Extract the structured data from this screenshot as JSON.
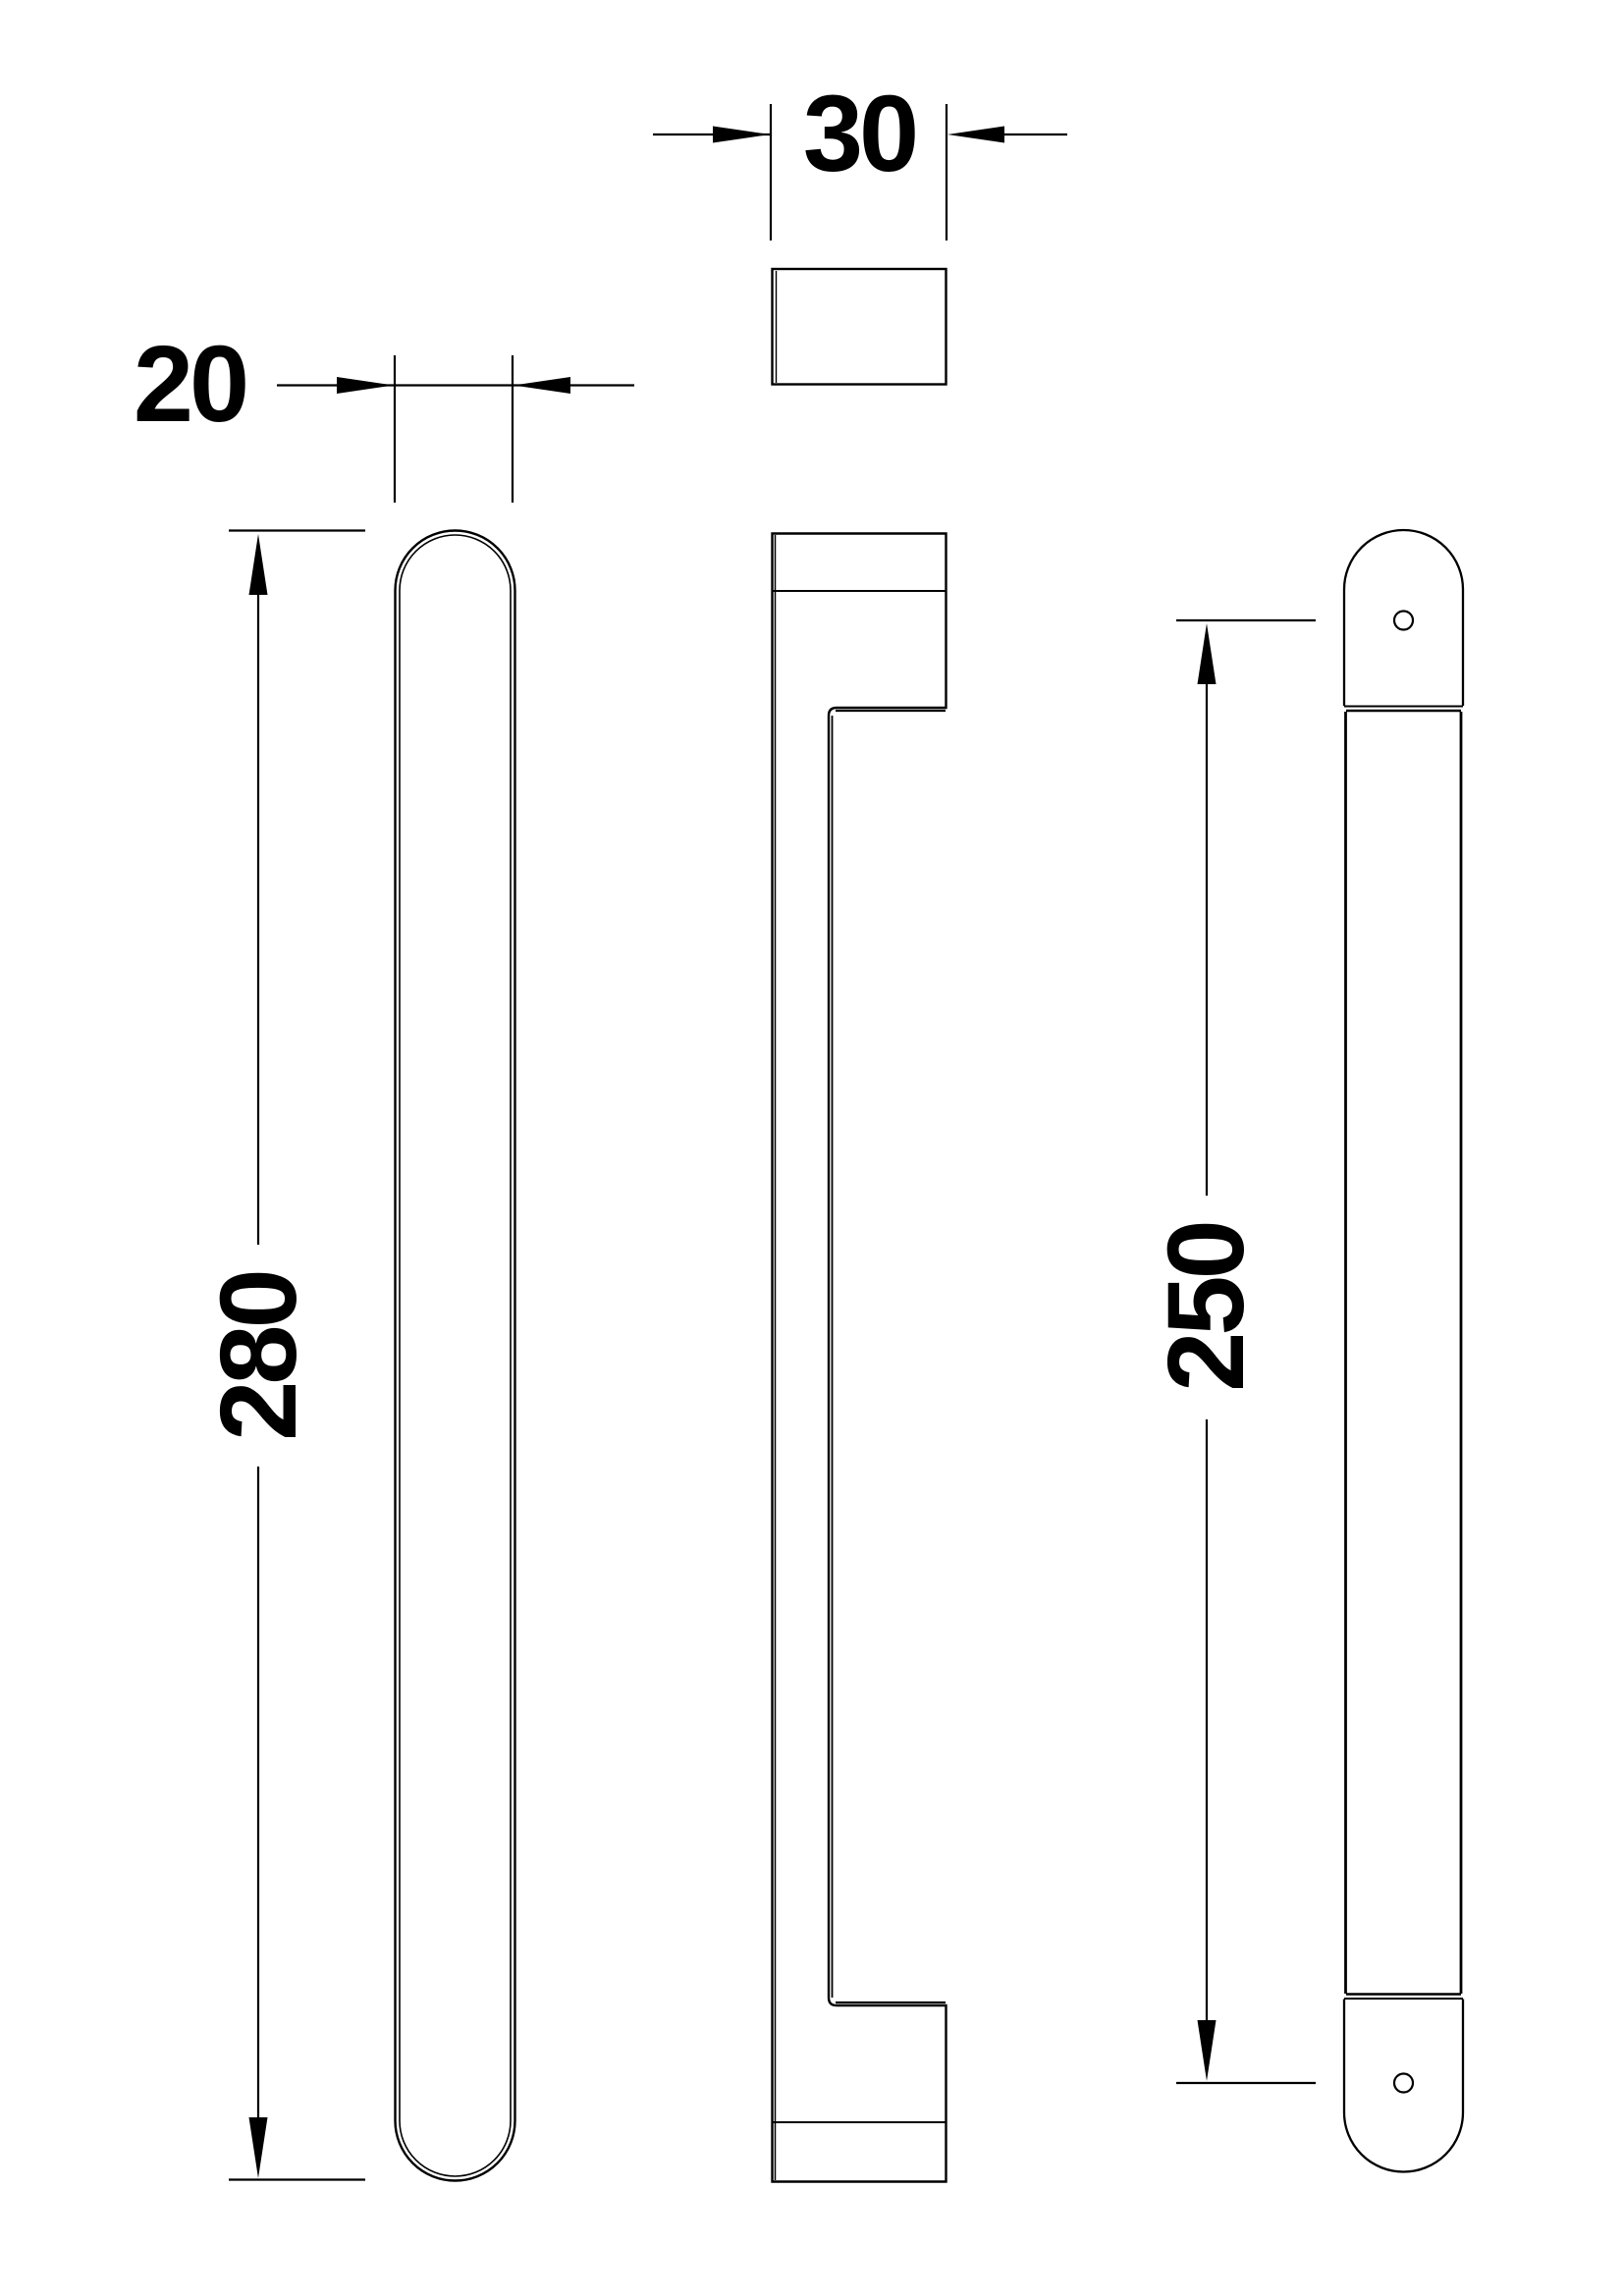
{
  "drawing": {
    "colors": {
      "background_color": "#ffffff",
      "line_color": "#000000"
    },
    "dimension_labels": {
      "grip_width_mm": "20",
      "section_depth_mm": "30",
      "overall_length_mm": "280",
      "fixing_centres_mm": "250"
    }
  }
}
